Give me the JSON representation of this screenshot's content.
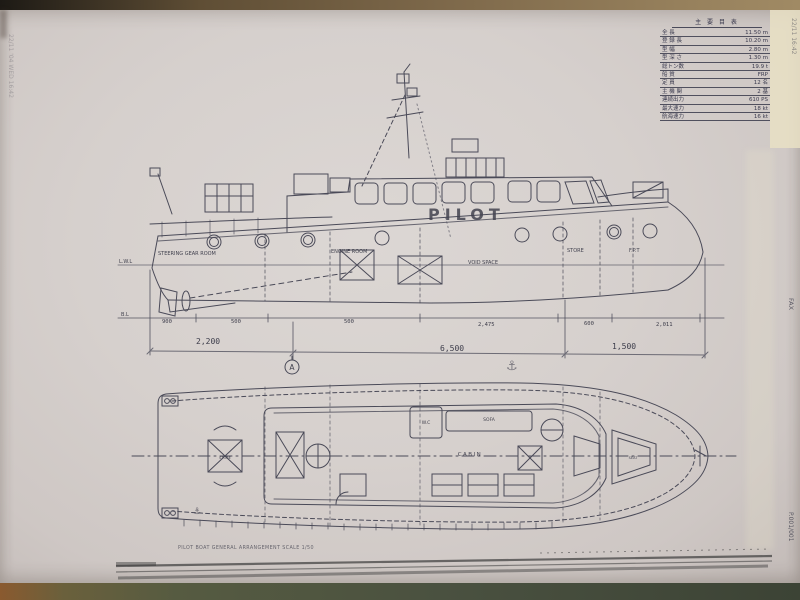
{
  "spec_table": {
    "title": "主 要 目 表",
    "rows": [
      {
        "label": "全  長",
        "value": "11.50 m"
      },
      {
        "label": "登 録 長",
        "value": "10.20 m"
      },
      {
        "label": "型  幅",
        "value": "2.80 m"
      },
      {
        "label": "型 深 さ",
        "value": "1.30 m"
      },
      {
        "label": "総トン数",
        "value": "19.9 t"
      },
      {
        "label": "船  質",
        "value": "FRP"
      },
      {
        "label": "定  員",
        "value": "12 名"
      },
      {
        "label": "主 機 関",
        "value": "2 基"
      },
      {
        "label": "連続出力",
        "value": "610 PS"
      },
      {
        "label": "最大速力",
        "value": "18 kt"
      },
      {
        "label": "航海速力",
        "value": "16 kt"
      }
    ]
  },
  "profile": {
    "boat_name": "PILOT",
    "compartments": {
      "steering": "STEERING GEAR ROOM",
      "engine": "ENGINE ROOM",
      "void": "VOID SPACE",
      "store": "STORE",
      "fpt": "F.P.T"
    },
    "waterline_label": "L.W.L",
    "baseline_label": "B.L",
    "sub_dims": [
      "900",
      "500",
      "500",
      "2,475",
      "600",
      "2,011"
    ],
    "main_dims": [
      "2,200",
      "6,500",
      "1,500"
    ],
    "section_marker": "A"
  },
  "plan": {
    "labels": {
      "store": "STORE",
      "wc": "W.C",
      "sofa": "SOFA",
      "cabin": "CABIN",
      "seat": "SEAT"
    },
    "note": "PILOT BOAT  GENERAL ARRANGEMENT  SCALE 1/50"
  },
  "fax_marks": {
    "left_edge": "22/11 '04 WED 16:42",
    "top_right_edge": "22/11 16:42",
    "right_edge": "FAX",
    "page": "P.001/001"
  }
}
